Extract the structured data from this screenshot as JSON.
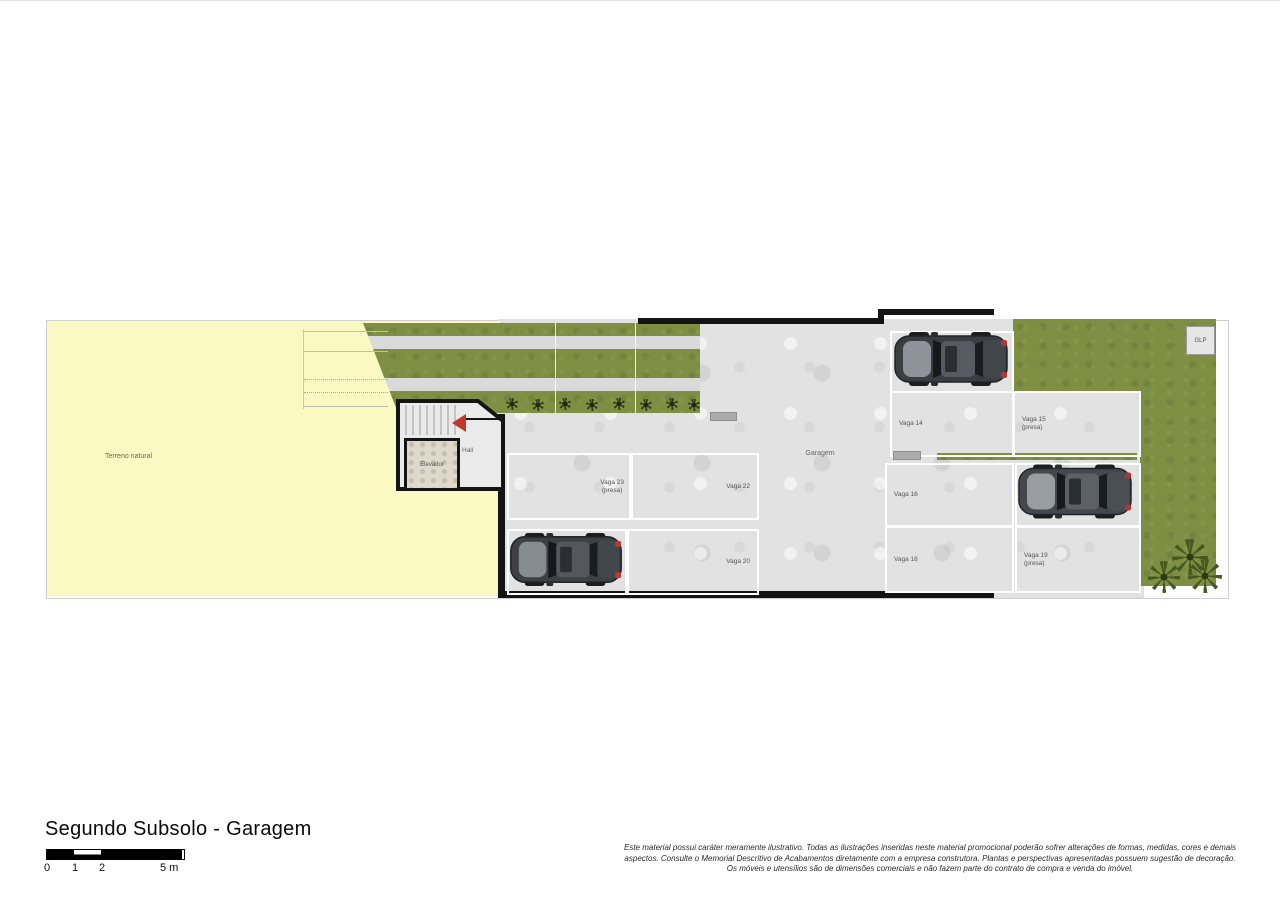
{
  "plan": {
    "areas": {
      "terreno": "Terreno natural",
      "garagem": "Garagem",
      "hall": "Hall",
      "elevador": "Elevador",
      "glp": "GLP"
    },
    "vagas": [
      {
        "id": 13,
        "name": "Vaga 13",
        "note": "",
        "has_car": true
      },
      {
        "id": 14,
        "name": "Vaga 14",
        "note": "",
        "has_car": false
      },
      {
        "id": 15,
        "name": "Vaga 15",
        "note": "(presa)",
        "has_car": false
      },
      {
        "id": 16,
        "name": "Vaga 16",
        "note": "",
        "has_car": false
      },
      {
        "id": 17,
        "name": "Vaga 17",
        "note": "(presa)",
        "has_car": true
      },
      {
        "id": 18,
        "name": "Vaga 18",
        "note": "",
        "has_car": false
      },
      {
        "id": 19,
        "name": "Vaga 19",
        "note": "(presa)",
        "has_car": false
      },
      {
        "id": 20,
        "name": "Vaga 20",
        "note": "",
        "has_car": false
      },
      {
        "id": 21,
        "name": "Vaga 21",
        "note": "(presa)",
        "has_car": true
      },
      {
        "id": 22,
        "name": "Vaga 22",
        "note": "",
        "has_car": false
      },
      {
        "id": 23,
        "name": "Vaga 23",
        "note": "(presa)",
        "has_car": false
      }
    ]
  },
  "footer": {
    "title": "Segundo Subsolo - Garagem",
    "scale": {
      "labels": [
        "0",
        "1",
        "2",
        "5 m"
      ]
    },
    "disclaimer_lines": [
      "Este material possui caráter meramente ilustrativo. Todas as ilustrações inseridas neste material promocional poderão sofrer alterações de formas, medidas, cores e demais",
      "aspectos. Consulte o Memorial Descritivo de Acabamentos diretamente com a empresa construtora. Plantas e perspectivas apresentadas possuem sugestão de decoração.",
      "Os móveis e utensílios são de dimensões comerciais e não fazem parte do contrato de compra e venda do imóvel."
    ]
  },
  "colors": {
    "terrain_yellow": "#faf8c3",
    "lawn_green": "#7e8e42",
    "concrete_gray": "#e2e2e2",
    "wall_black": "#141414",
    "arrow_red": "#c0392b",
    "spot_border_white": "#ffffff"
  }
}
